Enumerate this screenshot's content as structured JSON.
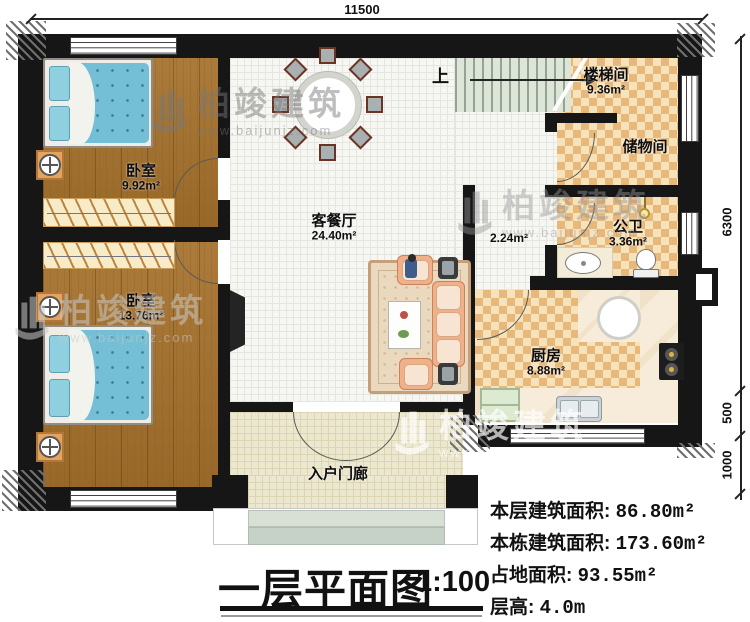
{
  "dimensions": {
    "top": "11500",
    "right_main": "6300",
    "right_mid": "500",
    "right_bottom": "1000"
  },
  "rooms": {
    "bedroom1": {
      "name": "卧室",
      "area": "9.92m²"
    },
    "bedroom2": {
      "name": "卧室",
      "area": "13.76m²"
    },
    "living": {
      "name": "客餐厅",
      "area": "24.40m²"
    },
    "stairwell": {
      "name": "楼梯间",
      "area": "9.36m²",
      "direction": "上"
    },
    "storage": {
      "name": "储物间"
    },
    "bathroom": {
      "name": "公卫",
      "area": "3.36m²"
    },
    "hallway": {
      "area": "2.24m²"
    },
    "kitchen": {
      "name": "厨房",
      "area": "8.88m²"
    },
    "porch": {
      "name": "入户门廊"
    }
  },
  "title_block": {
    "title": "一层平面图",
    "scale": "1:100"
  },
  "stats": {
    "rows": [
      {
        "label": "本层建筑面积: ",
        "value": "86.80m²"
      },
      {
        "label": "本栋建筑面积: ",
        "value": "173.60m²"
      },
      {
        "label": "占地面积: ",
        "value": "93.55m²"
      },
      {
        "label": "层高: ",
        "value": "4.0m"
      }
    ]
  },
  "watermark": {
    "brand": "柏竣建筑",
    "url": "www.baijunjz.com"
  },
  "colors": {
    "wall": "#161616",
    "checker_dark": "#e8b87a",
    "wood": "#a5712c",
    "mattress": "#74bed6"
  }
}
